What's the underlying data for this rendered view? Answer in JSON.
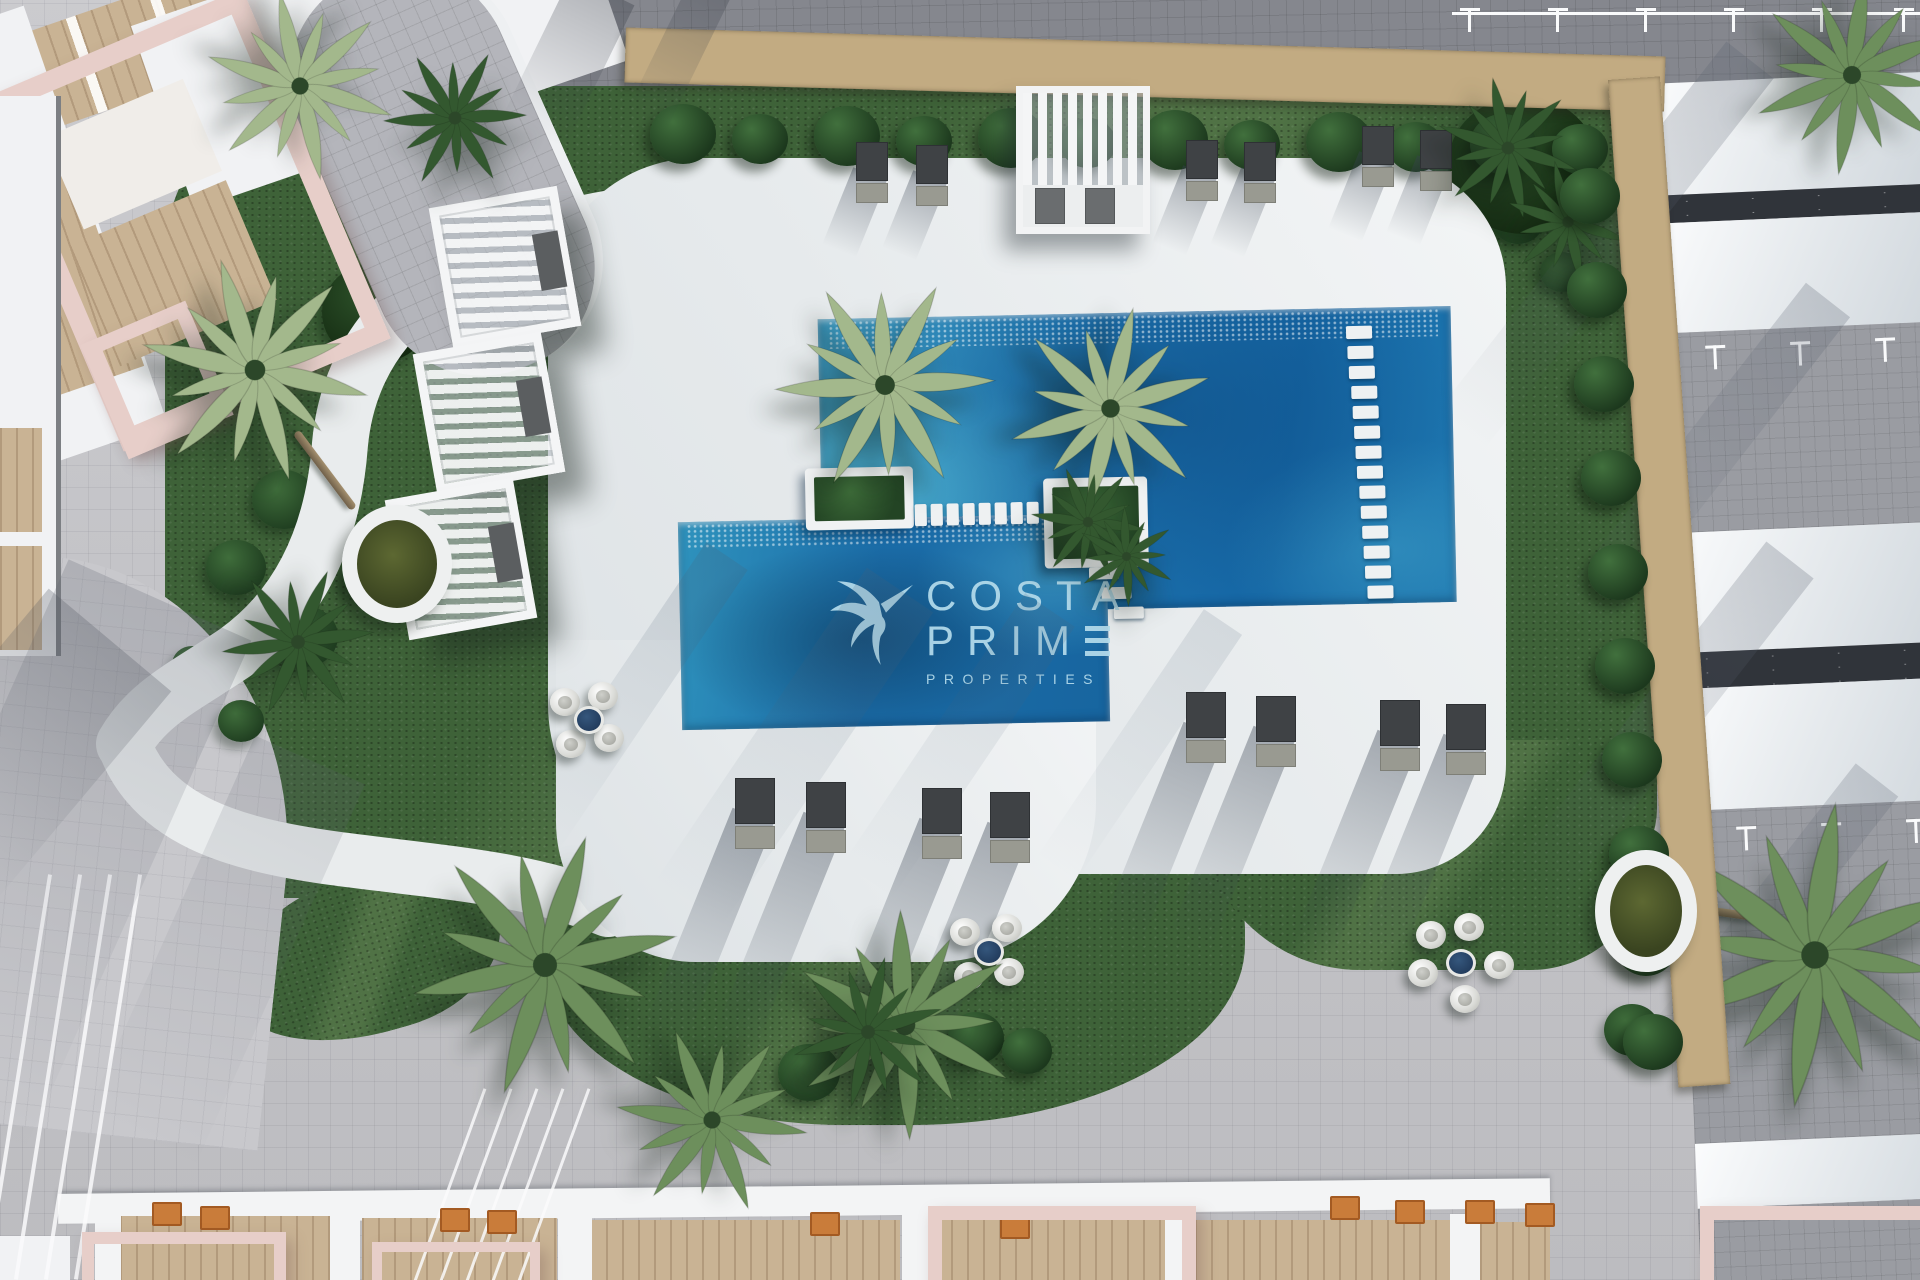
{
  "watermark": {
    "line1": "COSTA",
    "line2_prefix": "PRIM",
    "line2_e_glyph": "stylized-E-three-bars",
    "line3": "PROPERTIES"
  },
  "brand_icon": "hummingbird-logo-icon",
  "colors": {
    "pool_deep": "#1566a4",
    "pool_teal": "#3e9dc4",
    "deck_white": "#e9eced",
    "grass_green": "#3e6238",
    "hedge_green": "#1f3d20",
    "stone_tan": "#c2ab82",
    "paver_gray": "#c8c8cc",
    "road_gray": "#85878e",
    "blush_pink": "#e7cec9",
    "wood_tan": "#c9b394",
    "logo_blue": "#b5dcec",
    "lounger_dark": "#3f4245",
    "table_navy": "#223c5c"
  },
  "scene_counts": {
    "pool_stepping_stones": 8,
    "pool_bench_steps": 14,
    "garden_cabanas": 3,
    "top_sun_loungers": 6,
    "lower_sun_loungers": 8,
    "seating_pod_clusters": 3,
    "round_planter_rings": 2
  }
}
